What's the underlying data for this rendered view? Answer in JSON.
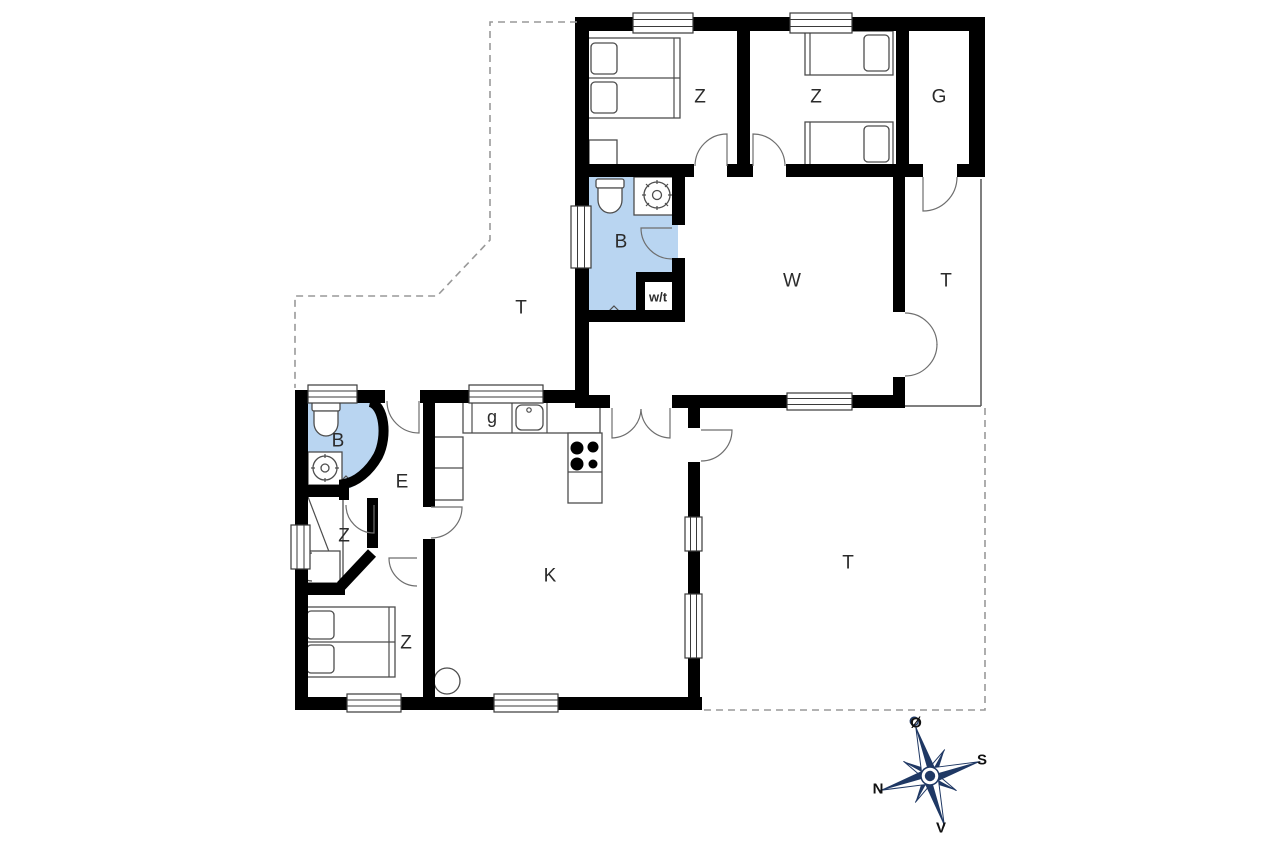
{
  "title": "holiday-house-floor-plan",
  "rooms": [
    {
      "id": "terrace-upper-left",
      "label": "T"
    },
    {
      "id": "bedroom-northwest",
      "label": "Z"
    },
    {
      "id": "bedroom-north",
      "label": "Z"
    },
    {
      "id": "storage-room",
      "label": "G"
    },
    {
      "id": "bathroom-upper",
      "label": "B"
    },
    {
      "id": "washer-dryer-closet",
      "label": "w/t"
    },
    {
      "id": "living-room",
      "label": "W"
    },
    {
      "id": "terrace-covered-east",
      "label": "T"
    },
    {
      "id": "bathroom-lower",
      "label": "B"
    },
    {
      "id": "wardrobe-nook",
      "label": "g"
    },
    {
      "id": "entrance-hall",
      "label": "E"
    },
    {
      "id": "bedroom-west",
      "label": "Z"
    },
    {
      "id": "kitchen",
      "label": "K"
    },
    {
      "id": "bedroom-southwest",
      "label": "Z"
    },
    {
      "id": "terrace-southeast",
      "label": "T"
    }
  ],
  "compass": {
    "east": "Ø",
    "south": "S",
    "north": "N",
    "west": "V"
  },
  "colors": {
    "wall": "#000000",
    "bathroom_fill": "#b9d5f1",
    "compass_navy": "#1f3864",
    "dashed_boundary": "#999999",
    "furniture_line": "#4d4d4d"
  }
}
